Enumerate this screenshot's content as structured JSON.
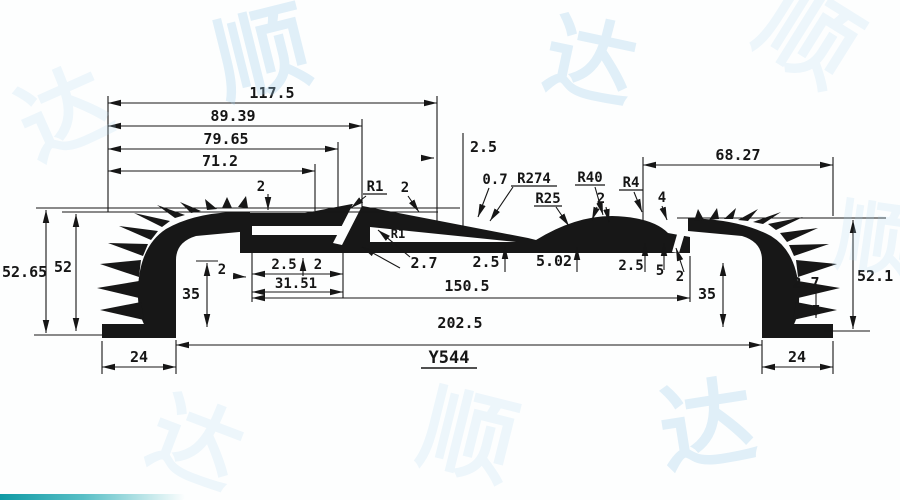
{
  "part": {
    "number": "Y544"
  },
  "dims": {
    "w1": "117.5",
    "w2": "89.39",
    "w3": "79.65",
    "w4": "71.2",
    "step": "2.5",
    "w_right": "68.27",
    "t_top2": "2",
    "r1": "R1",
    "t_slope2": "2",
    "t07": "0.7",
    "r274": "R274",
    "r25": "R25",
    "r40": "R40",
    "t_hump2": "2",
    "r4": "R4",
    "h4": "4",
    "h_5265": "52.65",
    "h_52": "52",
    "h35_l": "35",
    "t2_wall_l": "2",
    "slot_t25": "2.5",
    "slot_t2": "2",
    "slot_len": "31.51",
    "r1_gap": "R1",
    "t27_mid": "2.7",
    "t25_mid": "2.5",
    "t502": "5.02",
    "t25_r": "2.5",
    "t5_r": "5",
    "t2_r": "2",
    "span_inner": "150.5",
    "span_outer": "202.5",
    "h35_r": "35",
    "t27_r": "2.7",
    "h_521": "52.1",
    "foot_l": "24",
    "foot_r": "24"
  },
  "watermark": {
    "chars": [
      "顺",
      "达"
    ]
  },
  "colors": {
    "ink": "#161616",
    "watermark": "#a0cdeb",
    "teal": "#0f9aa4"
  }
}
